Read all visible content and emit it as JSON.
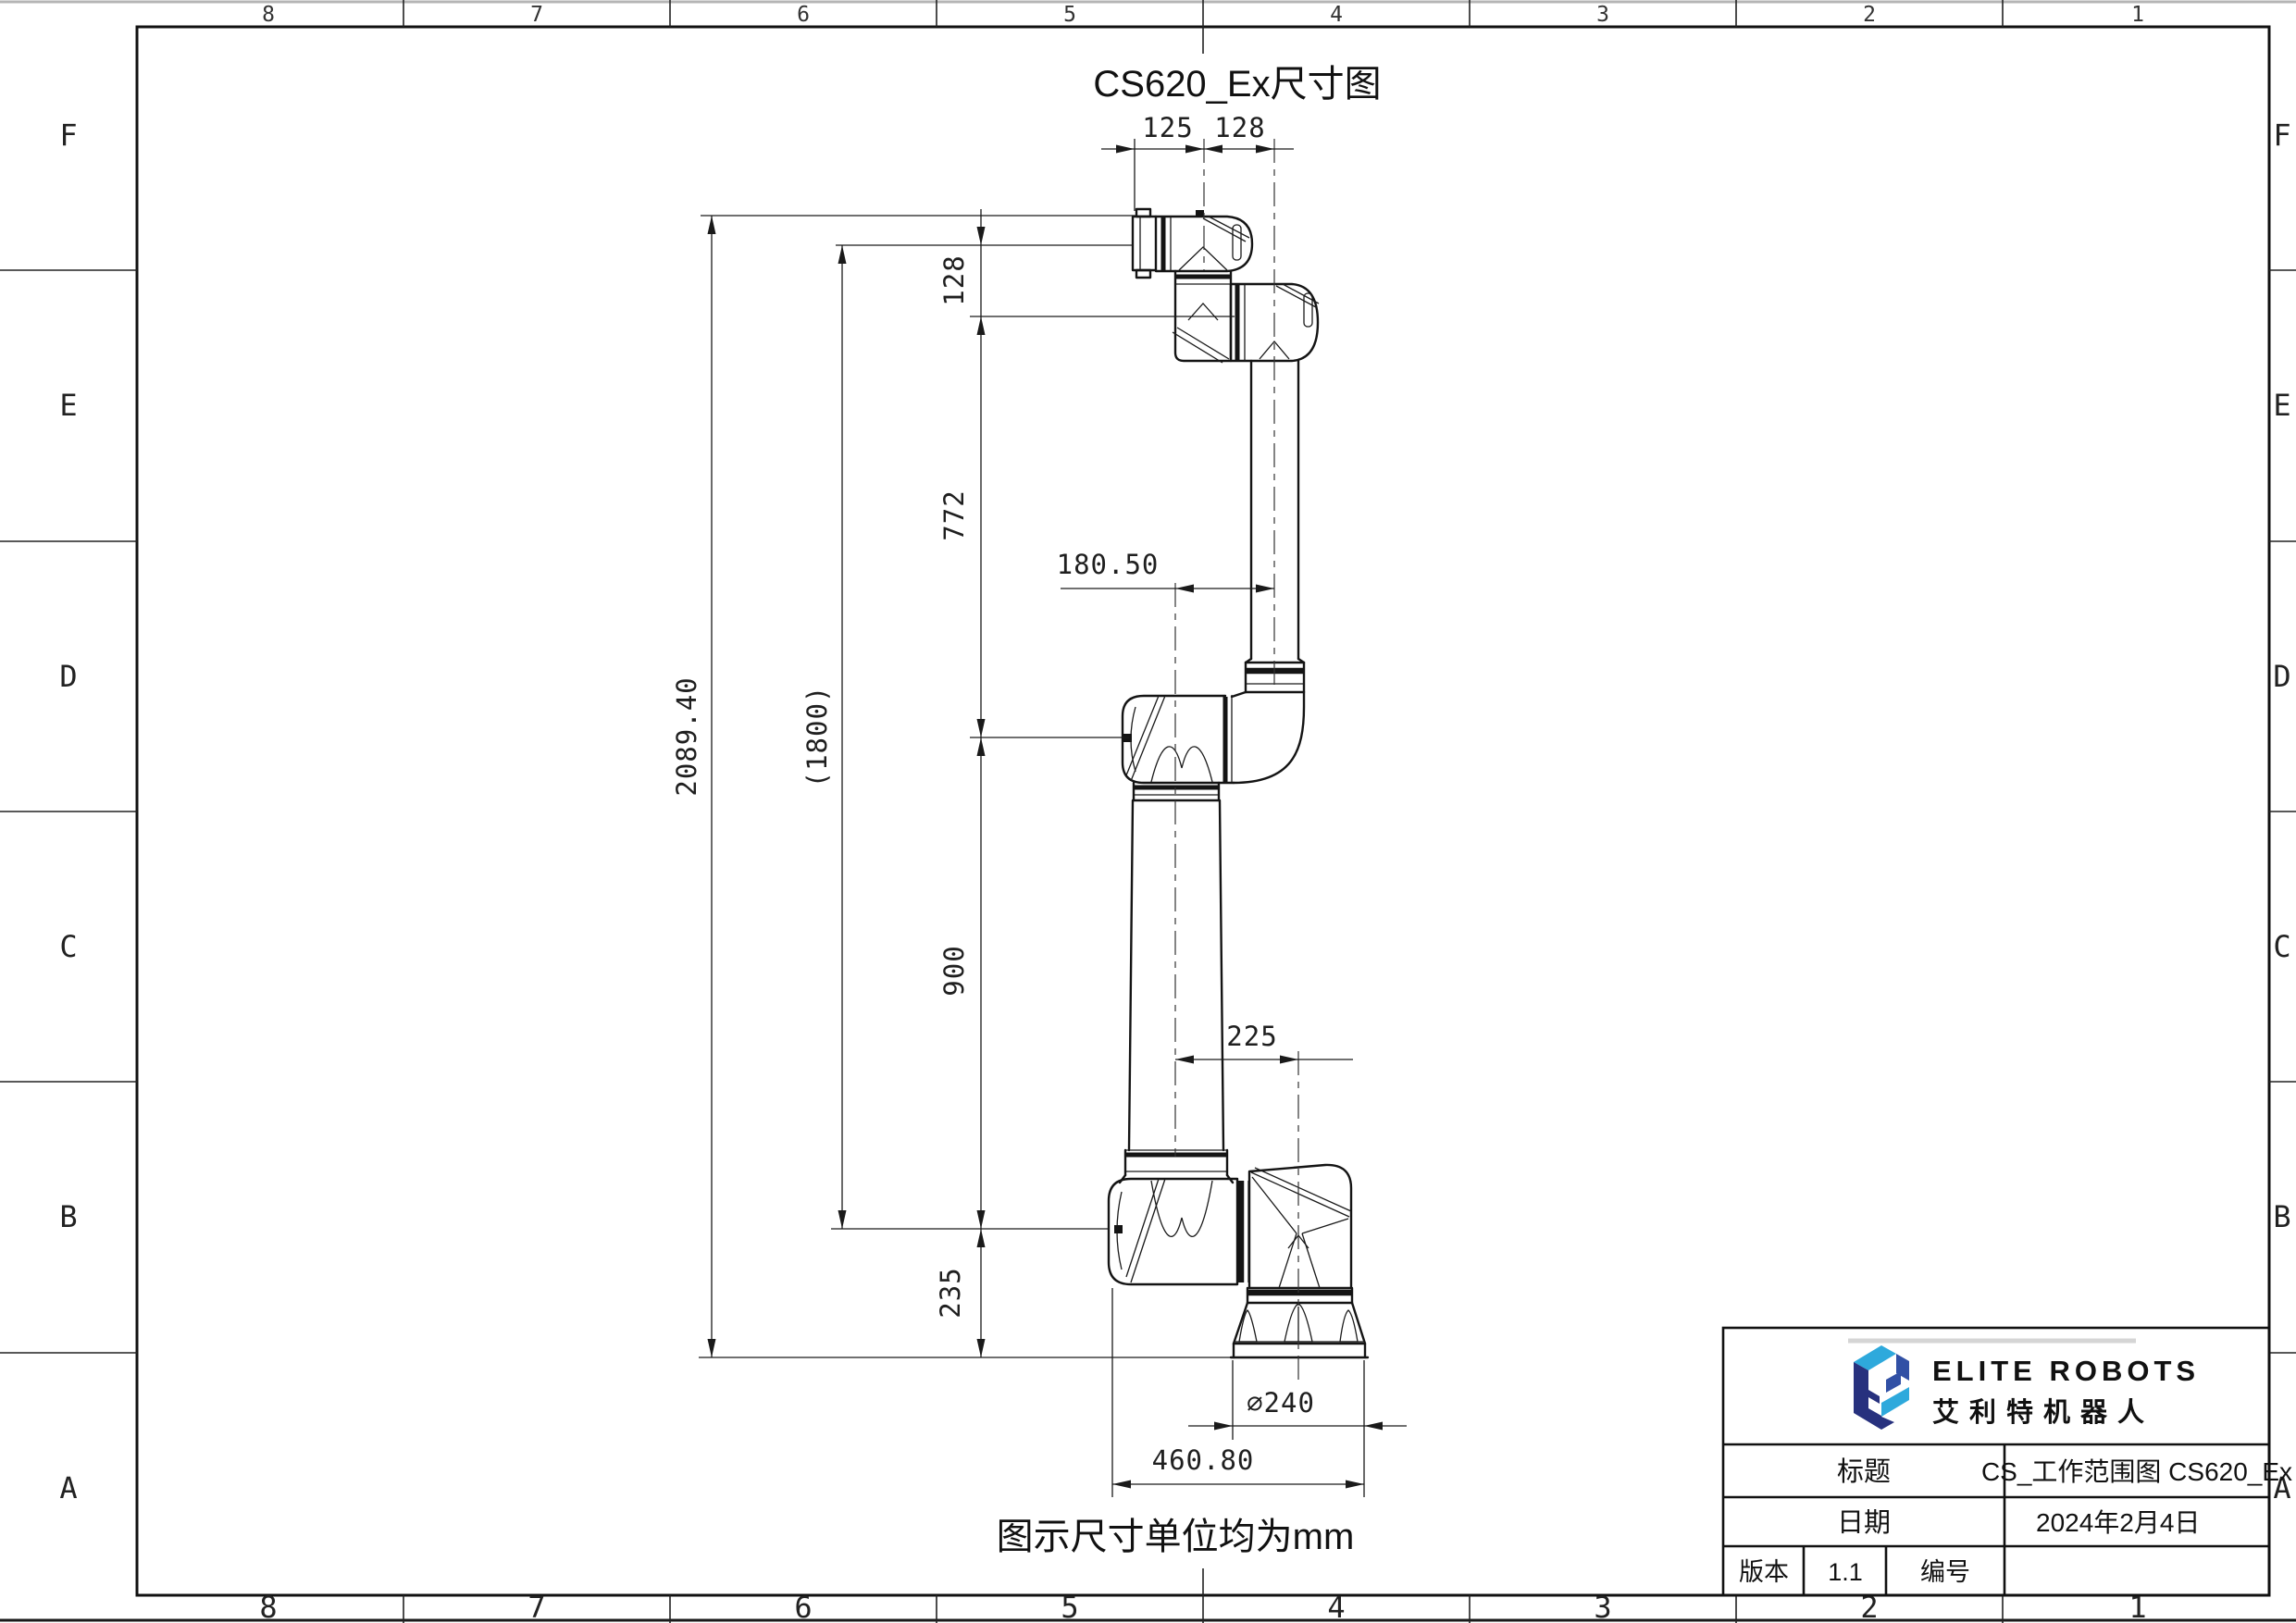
{
  "sheet": {
    "title": "CS620_Ex尺寸图",
    "caption": "图示尺寸单位均为mm",
    "zones": {
      "columns": [
        "8",
        "7",
        "6",
        "5",
        "4",
        "3",
        "2",
        "1"
      ],
      "rows": [
        "F",
        "E",
        "D",
        "C",
        "B",
        "A"
      ]
    }
  },
  "dimensions": {
    "flange_offset": "125",
    "wrist_offset": "128",
    "wrist_drop": "128",
    "upper_arm": "772",
    "lower_arm": "900",
    "base_height": "235",
    "total_height": "2089.40",
    "working_span": "(1800)",
    "elbow_offset": "180.50",
    "shoulder_offset": "225",
    "base_diameter": "⌀240",
    "base_width": "460.80"
  },
  "title_block": {
    "brand_en": "ELITE ROBOTS",
    "brand_cn": "艾利特机器人",
    "title_label": "标题",
    "title_value": "CS_工作范围图 CS620_Ex",
    "date_label": "日期",
    "date_value": "2024年2月4日",
    "version_label": "版本",
    "version_value": "1.1",
    "number_label": "编号",
    "number_value": ""
  },
  "colors": {
    "logo_navy": "#27317e",
    "logo_royal": "#3150a5",
    "logo_cyan": "#2ea9dc",
    "line": "#1a1a1a"
  }
}
